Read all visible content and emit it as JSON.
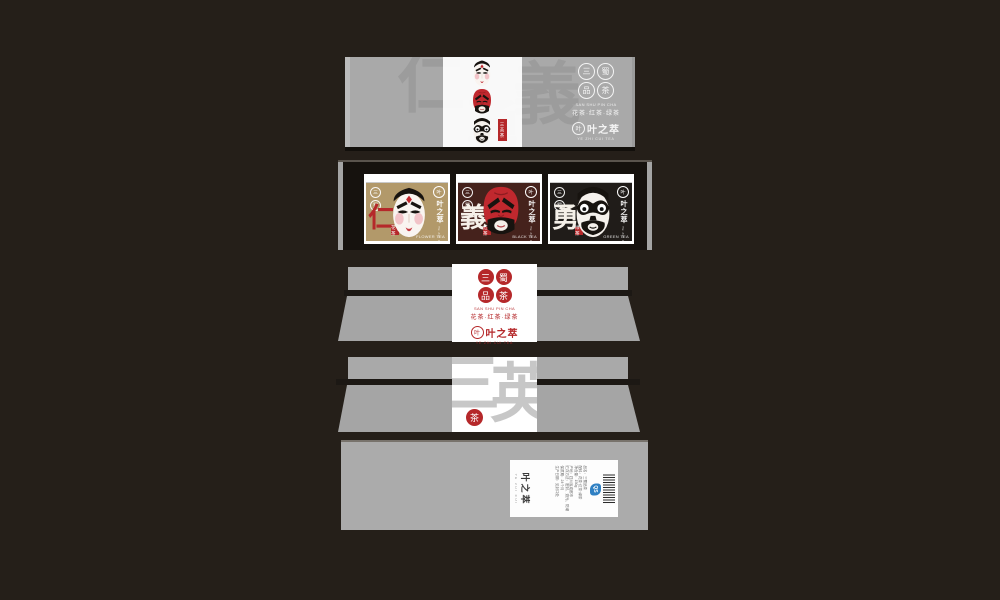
{
  "background": "#251f19",
  "colors": {
    "panel_gray": "#a9a9a9",
    "accent_red": "#b5282a",
    "pack_gold": "#b2996a",
    "pack_maroon": "#45221c",
    "pack_black": "#201c19"
  },
  "brand": {
    "seal_chars": [
      "三",
      "蜀",
      "品",
      "茶"
    ],
    "seal_pinyin": "SAN SHU PIN CHA",
    "tagline": "花茶·红茶·绿茶",
    "logo_glyph": "叶",
    "logo_name": "叶之萃",
    "logo_sub": "YE ZHI CUI TEA"
  },
  "lid": {
    "watermark_chars": [
      "仁",
      "義",
      "勇"
    ],
    "tag_label": "三英茶"
  },
  "packs": [
    {
      "virtue": "仁",
      "seal_top": "三",
      "seal_bottom": "蜀",
      "type_seal": "花茶",
      "type_en": "FLOWER TEA"
    },
    {
      "virtue": "義",
      "seal_top": "三",
      "seal_bottom": "蜀",
      "type_seal": "红茶",
      "type_en": "BLACK TEA"
    },
    {
      "virtue": "勇",
      "seal_top": "三",
      "seal_bottom": "蜀",
      "type_seal": "绿茶",
      "type_en": "GREEN TEA"
    }
  ],
  "back_panel": {
    "watermark_chars": [
      "三",
      "英"
    ],
    "seal_glyph": "茶"
  },
  "bottom_panel": {
    "brand_name": "叶之萃",
    "brand_sub": "YE ZHI CUI",
    "qs_label": "QS",
    "info_lines": [
      "品名：三蜀品茶",
      "配料：花茶·红茶·绿茶",
      "净含量：150g",
      "产地：四川省成都市",
      "贮存方法：密封、避光、防潮",
      "保质期：24个月",
      "生产日期：见封口处"
    ]
  }
}
